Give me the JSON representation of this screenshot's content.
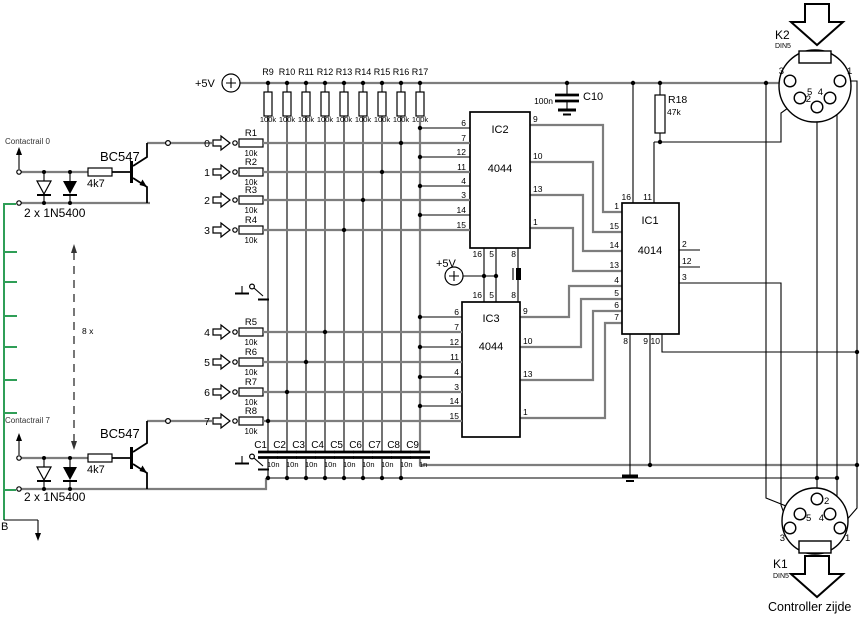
{
  "labels": {
    "vcc_top": "+5V",
    "vcc_mid": "+5V",
    "contactrail_top": "Contactrail 0",
    "contactrail_bottom": "Contactrail 7",
    "transistor_top": "BC547",
    "transistor_bottom": "BC547",
    "base_resistor_top": "4k7",
    "base_resistor_bottom": "4k7",
    "diode_pair_top": "2 x 1N5400",
    "diode_pair_bottom": "2 x 1N5400",
    "repeat_note": "8 x",
    "rail_return": "B",
    "controller_side": "Controller zijde"
  },
  "inputs": [
    "0",
    "1",
    "2",
    "3",
    "4",
    "5",
    "6",
    "7"
  ],
  "row_resistors": [
    {
      "name": "R1",
      "value": "10k"
    },
    {
      "name": "R2",
      "value": "10k"
    },
    {
      "name": "R3",
      "value": "10k"
    },
    {
      "name": "R4",
      "value": "10k"
    },
    {
      "name": "R5",
      "value": "10k"
    },
    {
      "name": "R6",
      "value": "10k"
    },
    {
      "name": "R7",
      "value": "10k"
    },
    {
      "name": "R8",
      "value": "10k"
    }
  ],
  "pullup_resistors": [
    {
      "name": "R9",
      "value": "100k"
    },
    {
      "name": "R10",
      "value": "100k"
    },
    {
      "name": "R11",
      "value": "100k"
    },
    {
      "name": "R12",
      "value": "100k"
    },
    {
      "name": "R13",
      "value": "100k"
    },
    {
      "name": "R14",
      "value": "100k"
    },
    {
      "name": "R15",
      "value": "100k"
    },
    {
      "name": "R16",
      "value": "100k"
    },
    {
      "name": "R17",
      "value": "100k"
    }
  ],
  "filter_caps": [
    {
      "name": "C1",
      "value": "10n"
    },
    {
      "name": "C2",
      "value": "10n"
    },
    {
      "name": "C3",
      "value": "10n"
    },
    {
      "name": "C4",
      "value": "10n"
    },
    {
      "name": "C5",
      "value": "10n"
    },
    {
      "name": "C6",
      "value": "10n"
    },
    {
      "name": "C7",
      "value": "10n"
    },
    {
      "name": "C8",
      "value": "10n"
    },
    {
      "name": "C9",
      "value": "1n"
    }
  ],
  "decoupling_cap": {
    "name": "C10",
    "value": "100n"
  },
  "pullup_r18": {
    "name": "R18",
    "value": "47k"
  },
  "ics": {
    "ic2": {
      "name": "IC2",
      "part": "4044",
      "pins_left": [
        "6",
        "7",
        "12",
        "11",
        "4",
        "3",
        "14",
        "15"
      ],
      "pins_right": [
        "9",
        "10",
        "13",
        "1"
      ],
      "pins_bottom": [
        "16",
        "5",
        "8"
      ]
    },
    "ic3": {
      "name": "IC3",
      "part": "4044",
      "pins_left": [
        "6",
        "7",
        "12",
        "11",
        "4",
        "3",
        "14",
        "15"
      ],
      "pins_right": [
        "9",
        "10",
        "13",
        "1"
      ],
      "pins_top": [
        "16",
        "5",
        "8"
      ]
    },
    "ic1": {
      "name": "IC1",
      "part": "4014",
      "pins_left": [
        "1",
        "15",
        "14",
        "13",
        "4",
        "5",
        "6",
        "7"
      ],
      "pins_top": [
        "16",
        "11"
      ],
      "pins_right": [
        "2",
        "12",
        "3"
      ],
      "pins_bottom": [
        "8",
        "9",
        "10"
      ]
    }
  },
  "connectors": {
    "k2": {
      "name": "K2",
      "type": "DIN5",
      "pins": [
        "3",
        "1",
        "5",
        "4",
        "2"
      ]
    },
    "k1": {
      "name": "K1",
      "type": "DIN5",
      "pins": [
        "2",
        "5",
        "4",
        "3",
        "1"
      ]
    }
  }
}
